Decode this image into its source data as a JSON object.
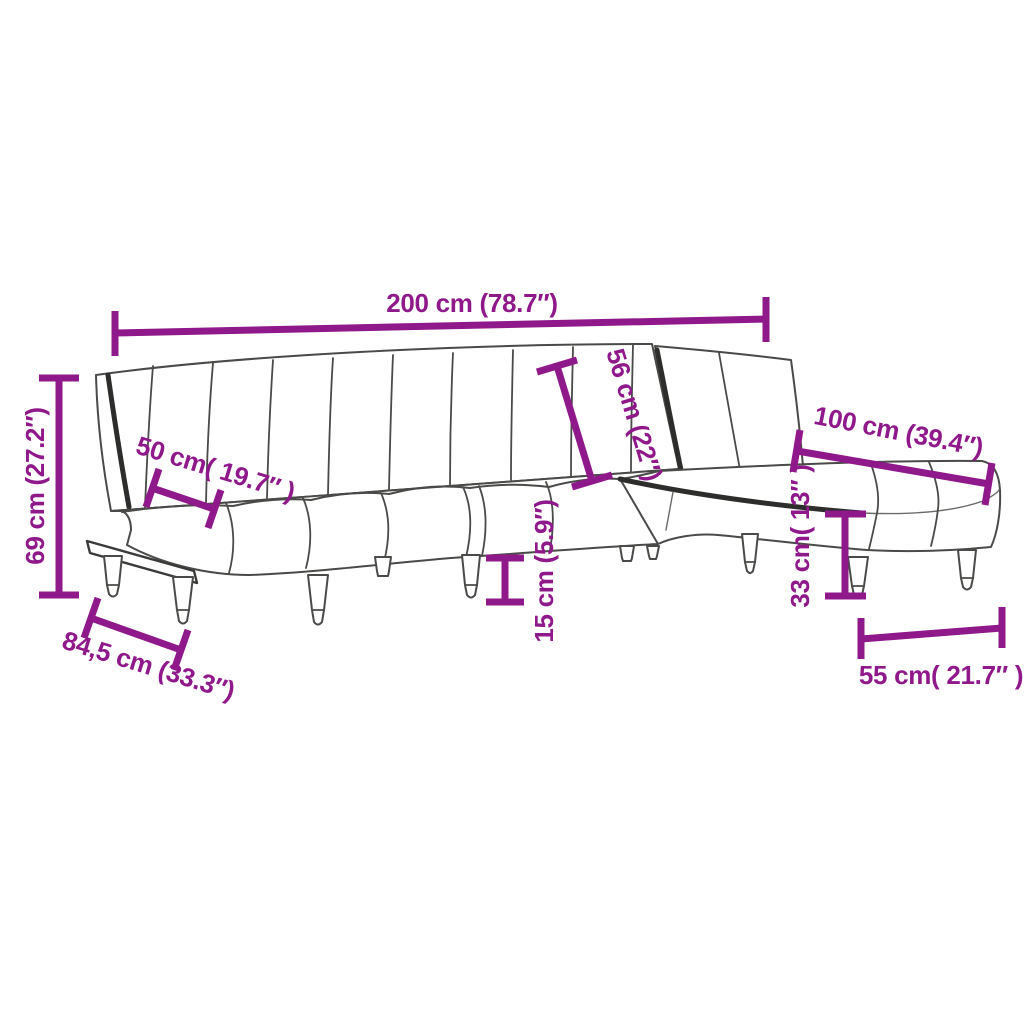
{
  "diagram": {
    "type": "product-dimension-diagram",
    "product": "L-shaped sofa bed with chaise lounge",
    "background_color": "#ffffff",
    "accent_color": "#8F188B",
    "line_art_color": "#4a4a48",
    "dark_edge_color": "#2d2d2c"
  },
  "labels": {
    "overall_length": "200 cm (78.7″)",
    "overall_height": "69 cm (27.2″)",
    "seat_section_width": "50 cm( 19.7″ )",
    "backrest_depth": "56 cm (22″)",
    "chaise_length": "100 cm (39.4″)",
    "leg_height": "15 cm (5.9″)",
    "base_depth": "84,5 cm (33.3″)",
    "chaise_seat_height": "33 cm( 13″ )",
    "chaise_width": "55 cm( 21.7″ )"
  }
}
